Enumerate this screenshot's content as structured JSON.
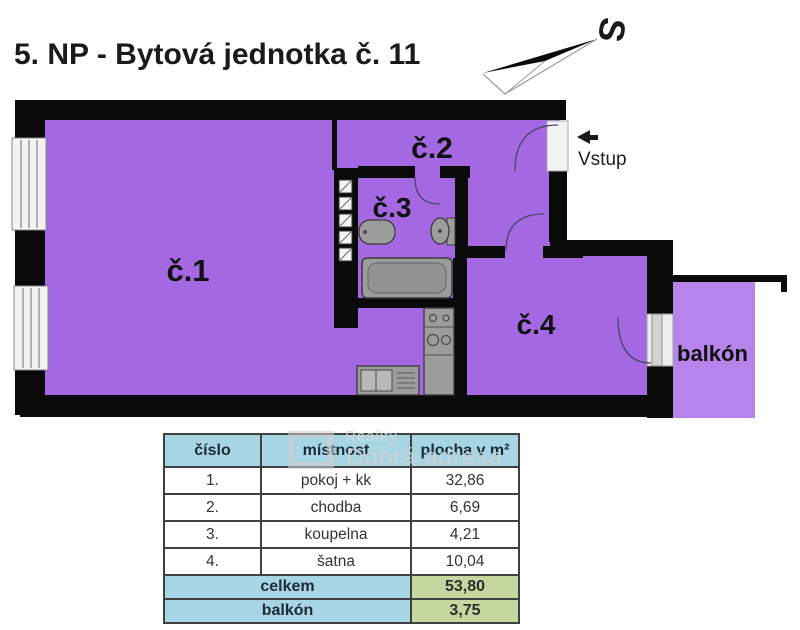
{
  "title": "5. NP - Bytová jednotka č. 11",
  "compass": {
    "north_label": "S"
  },
  "plan": {
    "room1_label": "č.1",
    "room2_label": "č.2",
    "room3_label": "č.3",
    "room4_label": "č.4",
    "balcony_label": "balkón",
    "entrance_label": "Vstup",
    "colors": {
      "room_fill": "#a468e2",
      "balcony_fill": "#b684ea",
      "wall": "#0a0a0a"
    }
  },
  "watermark": {
    "line1": "Reality",
    "line2": "Dobrá adresa"
  },
  "table": {
    "headers": {
      "number": "číslo",
      "room": "místnost",
      "area": "plocha v m²"
    },
    "rows": [
      {
        "number": "1.",
        "room": "pokoj + kk",
        "area": "32,86"
      },
      {
        "number": "2.",
        "room": "chodba",
        "area": "6,69"
      },
      {
        "number": "3.",
        "room": "koupelna",
        "area": "4,21"
      },
      {
        "number": "4.",
        "room": "šatna",
        "area": "10,04"
      }
    ],
    "total": {
      "label": "celkem",
      "value": "53,80"
    },
    "balcony": {
      "label": "balkón",
      "value": "3,75"
    },
    "colors": {
      "header_bg": "#a7d5e4",
      "value_bg": "#c6d8a0"
    }
  }
}
